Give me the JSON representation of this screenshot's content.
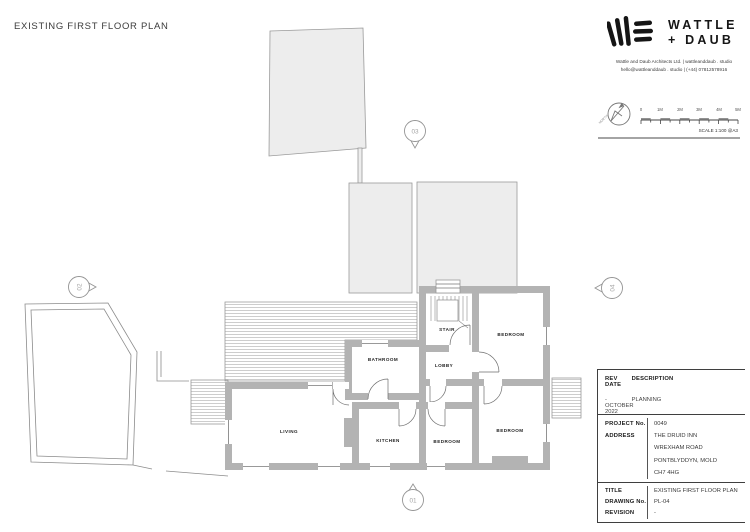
{
  "page": {
    "title": "EXISTING FIRST FLOOR PLAN"
  },
  "brand": {
    "name_line1": "WATTLE",
    "name_line2": "+ DAUB",
    "contact_line1": "Wattle and Daub Architects Ltd.  |  wattleanddaub . studio",
    "contact_line2": "hello@wattleanddaub . studio  |  (+44) 07812578916"
  },
  "map_key": {
    "north_label": "NORTH",
    "scale_ticks": [
      "0",
      "1M",
      "2M",
      "3M",
      "4M",
      "5M"
    ],
    "scale_label": "SCALE 1:100 @A3"
  },
  "plan": {
    "rooms": [
      {
        "label": "STAIR"
      },
      {
        "label": "BEDROOM"
      },
      {
        "label": "BATHROOM"
      },
      {
        "label": "LOBBY"
      },
      {
        "label": "LIVING"
      },
      {
        "label": "KITCHEN"
      },
      {
        "label": "BEDROOM"
      },
      {
        "label": "BEDROOM"
      }
    ],
    "markers": [
      {
        "id": "01"
      },
      {
        "id": "02"
      },
      {
        "id": "03"
      },
      {
        "id": "04"
      }
    ]
  },
  "revisions": {
    "headers": {
      "rev": "REV",
      "description": "DESCRIPTION",
      "date": "DATE"
    },
    "rows": [
      {
        "rev": "-",
        "description": "PLANNING",
        "date": "OCTOBER 2022"
      }
    ]
  },
  "project": {
    "project_no_label": "PROJECT No.",
    "project_no": "0049",
    "address_label": "ADDRESS",
    "address_line1": "THE DRUID INN",
    "address_line2": "WREXHAM ROAD",
    "address_line3": "PONTBLYDDYN, MOLD",
    "address_line4": "CH7 4HG"
  },
  "titleblock": {
    "title_label": "TITLE",
    "title": "EXISTING FIRST FLOOR PLAN",
    "drawing_no_label": "DRAWING No.",
    "drawing_no": "PL-04",
    "revision_label": "REVISION",
    "revision": "-"
  },
  "colors": {
    "wall": "#b3b3b3",
    "roof_fill": "#ededed",
    "line": "#8c8c8c",
    "ink": "#1f1f1f"
  }
}
